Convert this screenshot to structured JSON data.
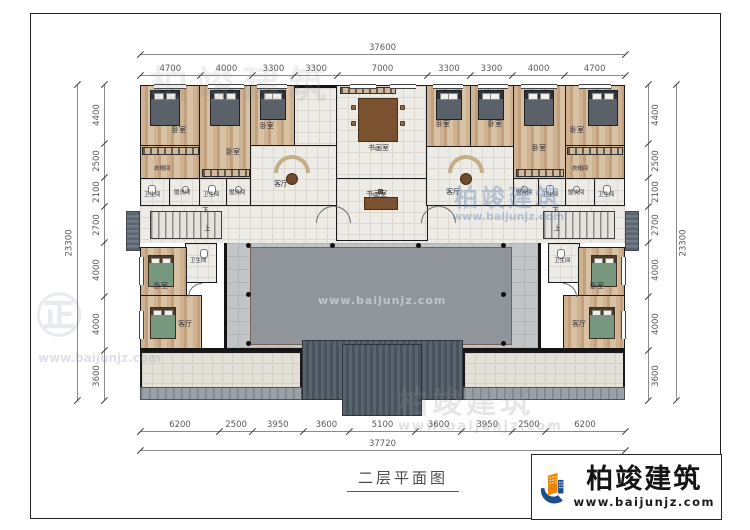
{
  "title": {
    "text": "二层平面图"
  },
  "logo": {
    "brand": "柏竣建筑",
    "url": "www.baijunjz.com"
  },
  "watermark": {
    "brand": "柏竣建筑",
    "url": "www.baijunjz.com"
  },
  "dims": {
    "top": {
      "total": "37600",
      "segments": [
        "4700",
        "4000",
        "3300",
        "3300",
        "7000",
        "3300",
        "3300",
        "4000",
        "4700"
      ]
    },
    "bottom": {
      "total": "37720",
      "segments": [
        "6200",
        "2500",
        "3950",
        "3600",
        "5100",
        "3600",
        "3950",
        "2500",
        "6200"
      ]
    },
    "left": {
      "total": "23300",
      "segments": [
        "4400",
        "2500",
        "2100",
        "2700",
        "4000",
        "4000",
        "3600"
      ]
    },
    "right": {
      "total": "23300",
      "segments": [
        "4400",
        "2500",
        "2100",
        "2700",
        "4000",
        "4000",
        "3600"
      ]
    }
  },
  "rooms": {
    "bedroom": "卧室",
    "studio": "书画室",
    "living_room": "客厅",
    "cloakroom": "衣帽间",
    "bathroom": "卫生间",
    "washroom": "盥洗间",
    "stairs_down": "下",
    "stairs_up": "上"
  },
  "colors": {
    "accent_orange": "#f08300",
    "accent_blue": "#1b4e8e"
  }
}
